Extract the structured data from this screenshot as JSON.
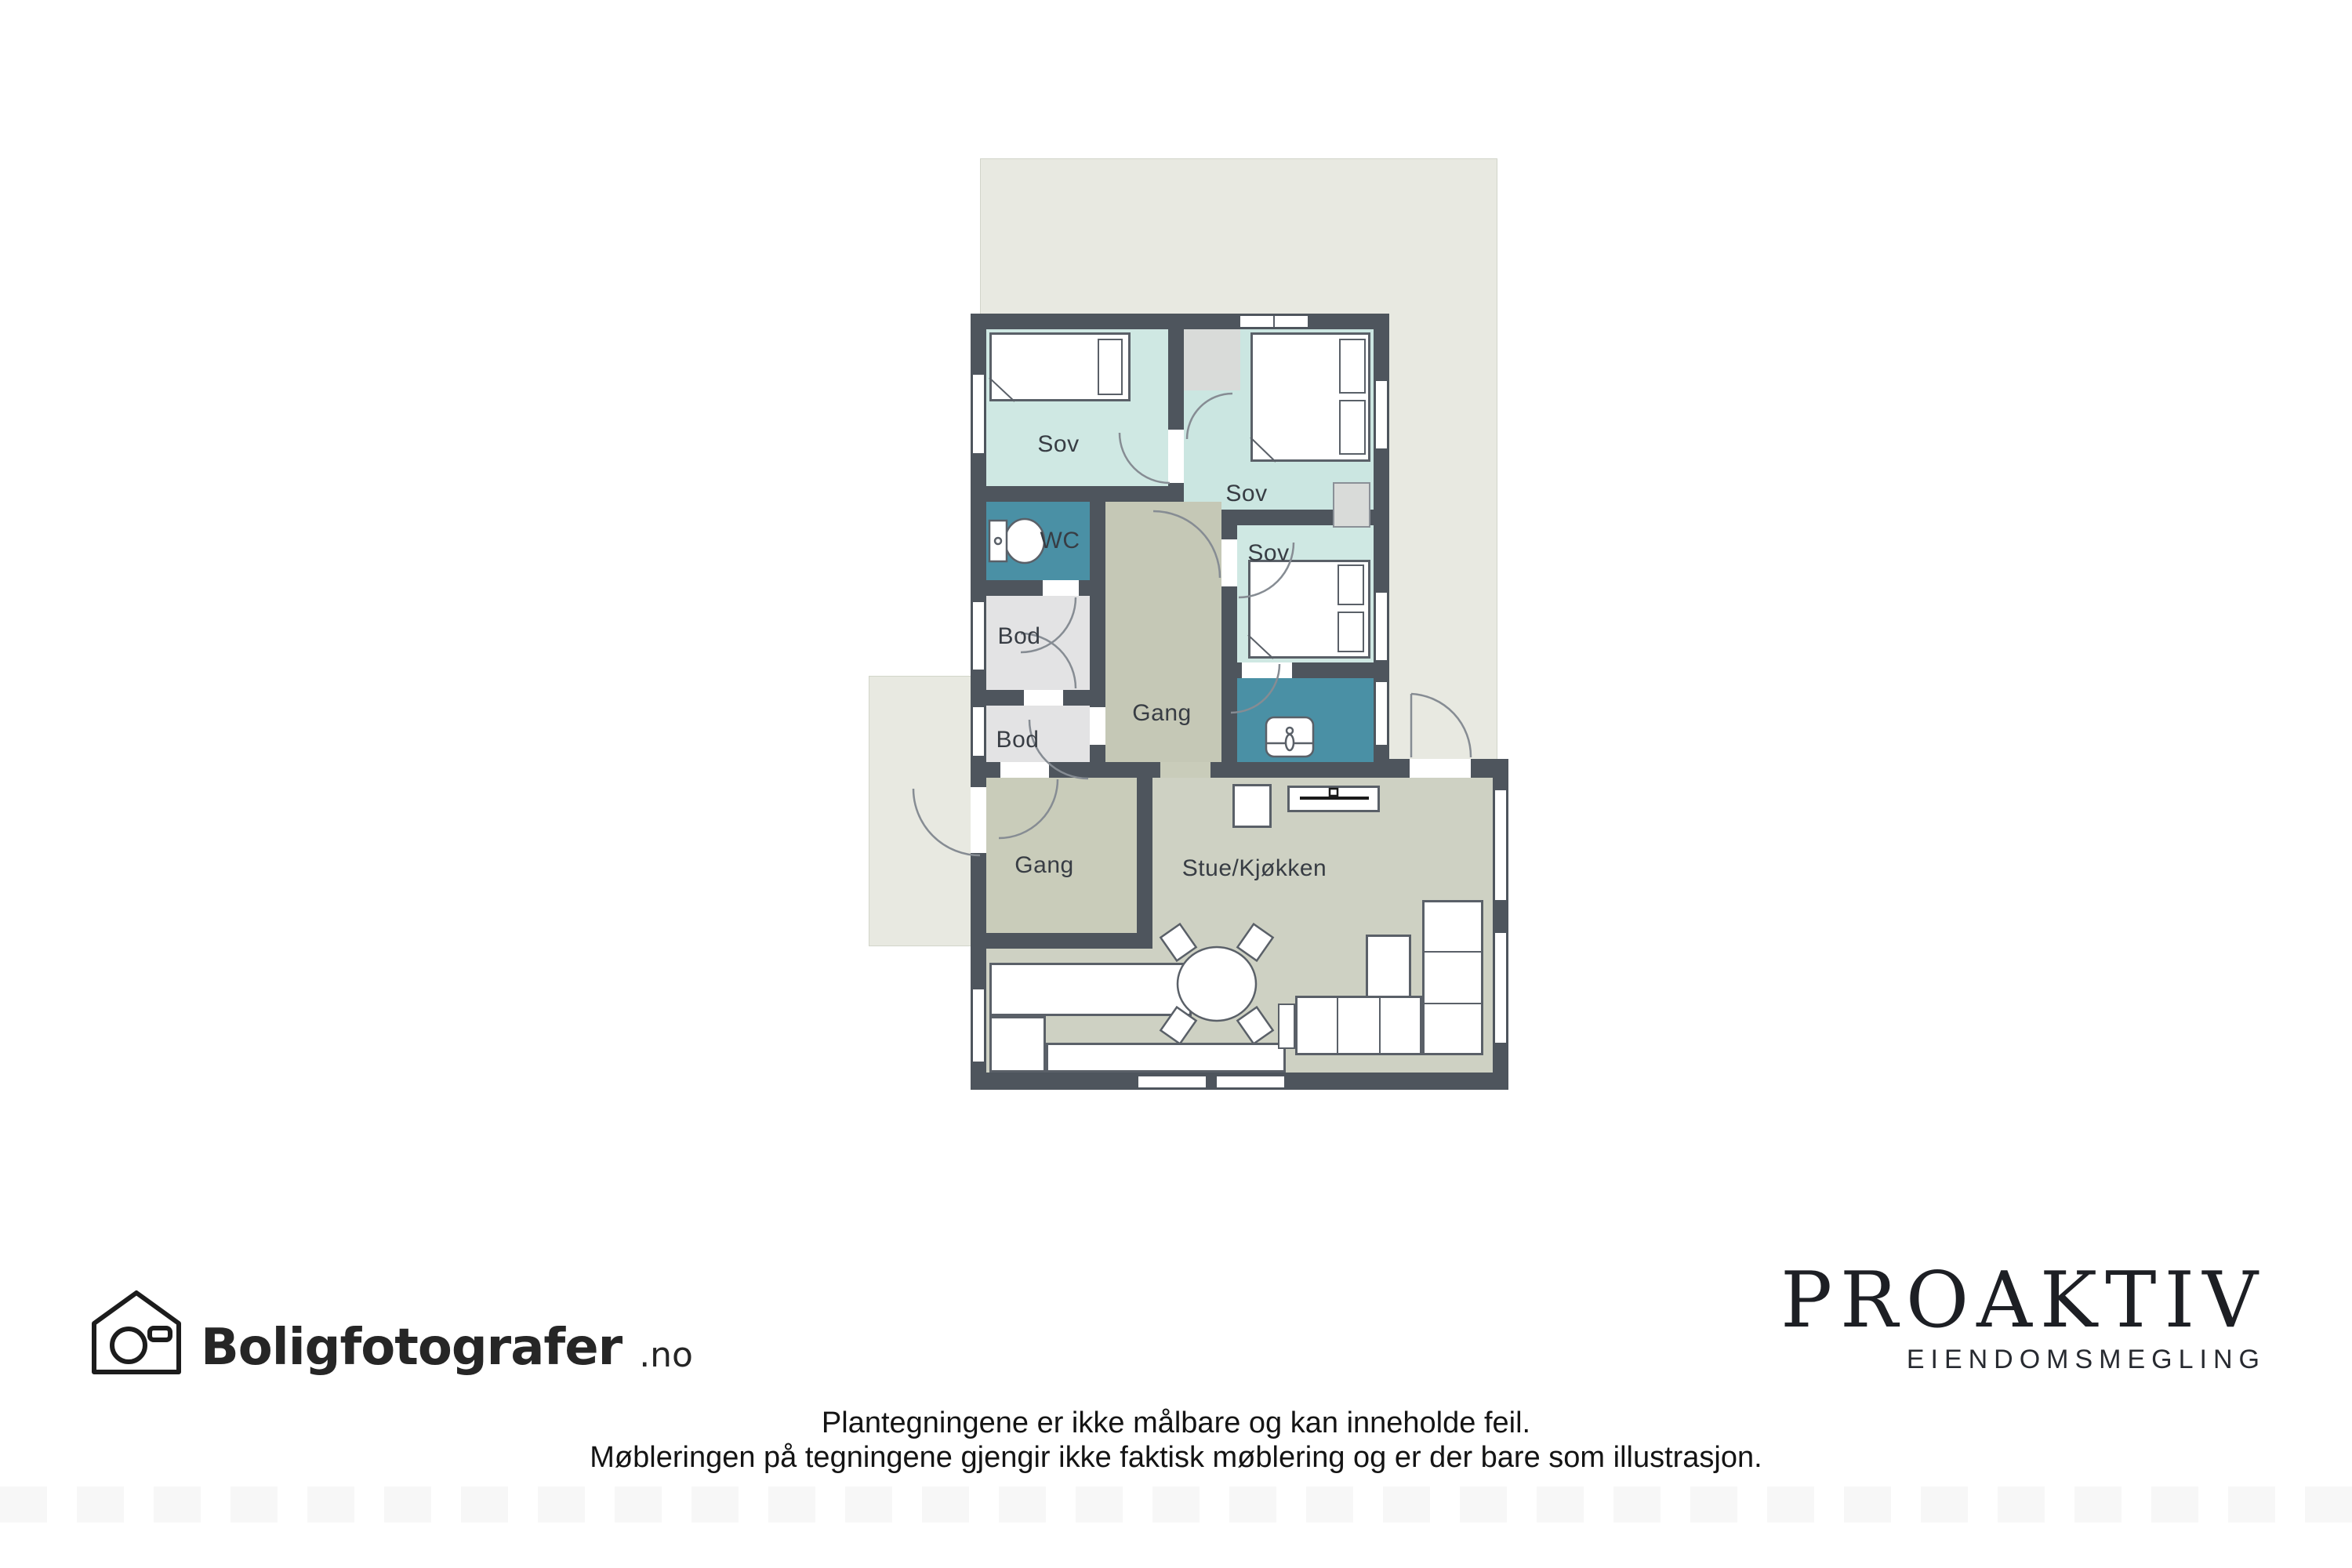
{
  "plan": {
    "rooms": [
      {
        "id": "sov-1",
        "label": "Sov"
      },
      {
        "id": "sov-2",
        "label": "Sov"
      },
      {
        "id": "sov-3",
        "label": "Sov"
      },
      {
        "id": "wc",
        "label": "WC"
      },
      {
        "id": "bod-1",
        "label": "Bod"
      },
      {
        "id": "bod-2",
        "label": "Bod"
      },
      {
        "id": "gang-center",
        "label": "Gang"
      },
      {
        "id": "gang-entry",
        "label": "Gang"
      },
      {
        "id": "stue-kjokken",
        "label": "Stue/Kjøkken"
      }
    ],
    "palette": {
      "wall": "#4e555d",
      "bedroom": "#cfe8e3",
      "bathroom": "#4a90a5",
      "storage": "#e3e3e4",
      "hall": "#c5c8b6",
      "living": "#ced1c3",
      "outdoor": "#e8e9e1"
    }
  },
  "footer": {
    "photographer_logo": {
      "icon": "house-camera-icon",
      "name": "Boligfotografer",
      "tld": ".no"
    },
    "agency_logo": {
      "name": "PROAKTIV",
      "subtitle": "EIENDOMSMEGLING"
    },
    "disclaimer_line1": "Plantegningene er ikke målbare og kan inneholde feil.",
    "disclaimer_line2": "Møbleringen på tegningene gjengir ikke faktisk møblering og er der bare som illustrasjon."
  }
}
